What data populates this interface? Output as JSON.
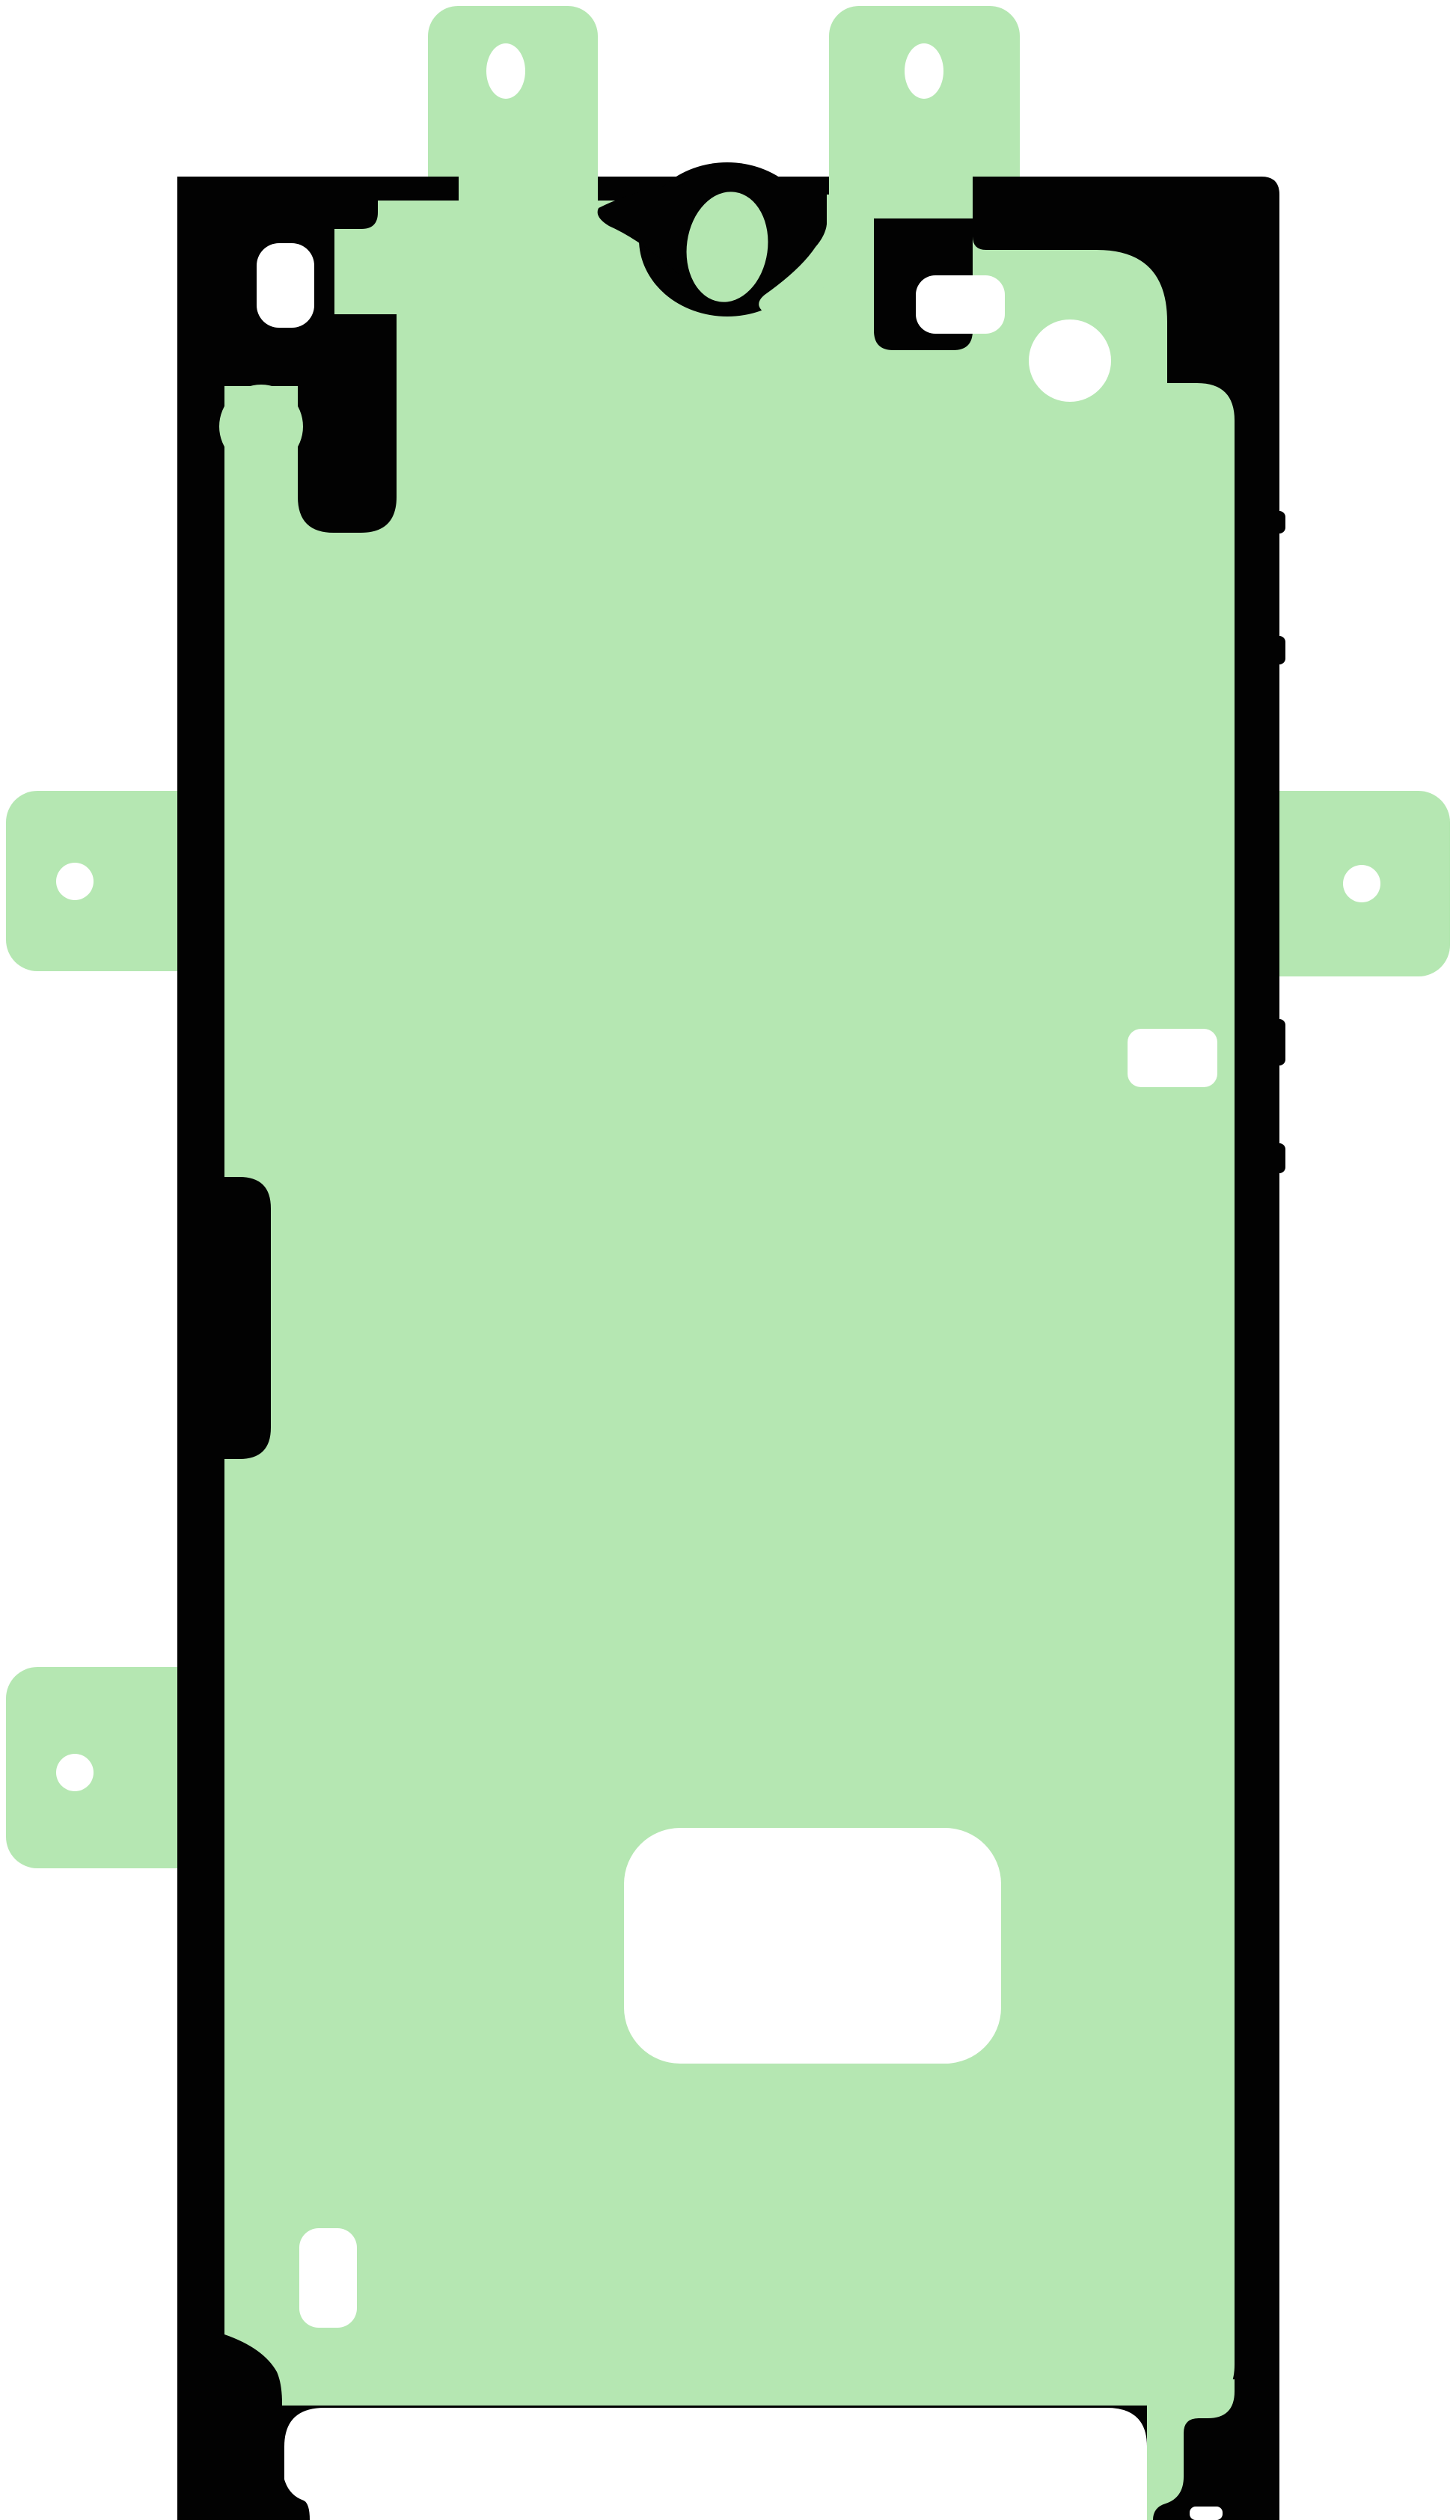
{
  "page": {
    "title": "Smartphone display adhesive sticker — product illustration",
    "background": "#ffffff"
  },
  "colors": {
    "adhesive_green": "#b5e7b2",
    "outline_black": "#020202",
    "cutout_white": "#ffffff"
  },
  "illustration": {
    "subject": "Front display adhesive gasket (portrait) with protective-liner pull tabs",
    "orientation": "portrait",
    "parts": [
      {
        "name": "top-left-pull-tab",
        "feature": "rounded liner tab with oval hole"
      },
      {
        "name": "top-right-pull-tab",
        "feature": "rounded liner tab with oval hole"
      },
      {
        "name": "left-upper-pull-tab",
        "feature": "side liner tab with round hole"
      },
      {
        "name": "right-pull-tab",
        "feature": "side liner tab with round hole"
      },
      {
        "name": "left-lower-pull-tab",
        "feature": "side liner tab with round hole"
      },
      {
        "name": "adhesive-outline",
        "feature": "black die-cut outline frame"
      },
      {
        "name": "adhesive-area",
        "feature": "green adhesive film"
      },
      {
        "name": "sensor-slot-cutout",
        "feature": "white rounded slot, upper left"
      },
      {
        "name": "front-camera-ring",
        "feature": "black ring with tilted green oval"
      },
      {
        "name": "sensor-rect-cutout",
        "feature": "white rounded rectangle, upper right"
      },
      {
        "name": "sensor-circle-cutout",
        "feature": "white circle, upper right"
      },
      {
        "name": "side-button-cutout",
        "feature": "white rounded rectangle, right edge"
      },
      {
        "name": "port-cutout",
        "feature": "large white rounded rectangle, lower center"
      },
      {
        "name": "lower-left-cutout",
        "feature": "small white rounded rectangle"
      },
      {
        "name": "bottom-opening",
        "feature": "white opening across bottom edge"
      },
      {
        "name": "bottom-edge-notch",
        "feature": "small white notch, bottom right"
      }
    ]
  }
}
